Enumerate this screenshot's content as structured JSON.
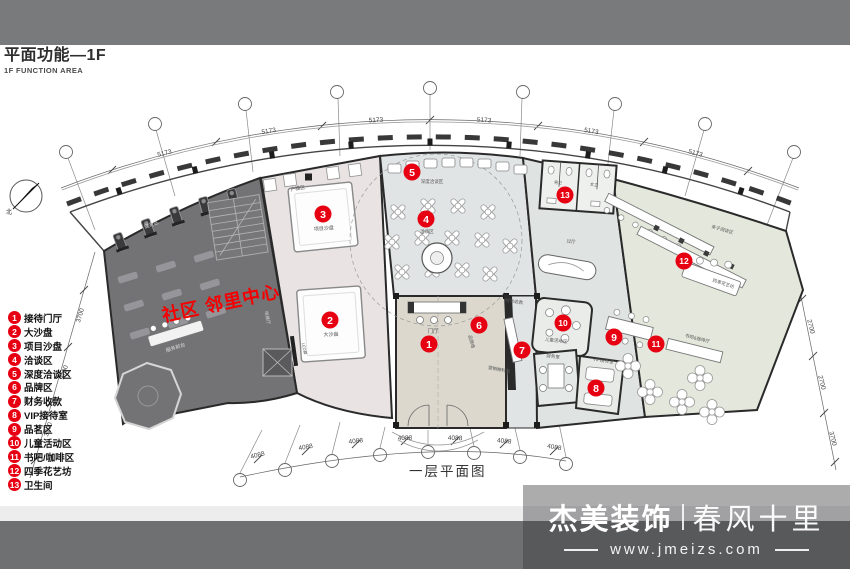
{
  "header": {
    "title": "平面功能—1F",
    "subtitle": "1F FUNCTION AREA"
  },
  "compass": {
    "label": "北"
  },
  "plan": {
    "title": "一层平面图",
    "overlay_text": "社区 邻里中心",
    "accent_red": "#e60012",
    "markers": [
      {
        "n": "1",
        "x": 429,
        "y": 344
      },
      {
        "n": "2",
        "x": 330,
        "y": 320
      },
      {
        "n": "3",
        "x": 323,
        "y": 214
      },
      {
        "n": "4",
        "x": 426,
        "y": 219
      },
      {
        "n": "5",
        "x": 412,
        "y": 172
      },
      {
        "n": "6",
        "x": 479,
        "y": 325
      },
      {
        "n": "7",
        "x": 522,
        "y": 350
      },
      {
        "n": "8",
        "x": 596,
        "y": 388
      },
      {
        "n": "9",
        "x": 614,
        "y": 337
      },
      {
        "n": "10",
        "x": 563,
        "y": 323
      },
      {
        "n": "11",
        "x": 656,
        "y": 344
      },
      {
        "n": "12",
        "x": 684,
        "y": 261
      },
      {
        "n": "13",
        "x": 565,
        "y": 195
      }
    ],
    "room_labels": [
      {
        "text": "健身区",
        "x": 152,
        "y": 226,
        "rot": -20,
        "size": 5,
        "color": "#dedede"
      },
      {
        "text": "服务前台",
        "x": 176,
        "y": 349,
        "rot": -18,
        "size": 5,
        "color": "#dedede"
      },
      {
        "text": "电梯厅",
        "x": 266,
        "y": 318,
        "rot": 78,
        "size": 4.5,
        "color": "#cfcfcf"
      },
      {
        "text": "户模区",
        "x": 298,
        "y": 190,
        "rot": -10,
        "size": 5,
        "color": "#555"
      },
      {
        "text": "项目沙盘",
        "x": 324,
        "y": 230,
        "rot": -4,
        "size": 5,
        "color": "#555"
      },
      {
        "text": "大沙盘",
        "x": 331,
        "y": 336,
        "rot": -2,
        "size": 5,
        "color": "#555"
      },
      {
        "text": "LED屏",
        "x": 303,
        "y": 349,
        "rot": 78,
        "size": 4,
        "color": "#555"
      },
      {
        "text": "深度洽谈区",
        "x": 432,
        "y": 183,
        "rot": 0,
        "size": 4.5,
        "color": "#555"
      },
      {
        "text": "洽谈区",
        "x": 427,
        "y": 233,
        "rot": 0,
        "size": 4.5,
        "color": "#555"
      },
      {
        "text": "门厅",
        "x": 433,
        "y": 333,
        "rot": 0,
        "size": 5.5,
        "color": "#555"
      },
      {
        "text": "品牌墙",
        "x": 470,
        "y": 342,
        "rot": 75,
        "size": 4.5,
        "color": "#555"
      },
      {
        "text": "营销物料间",
        "x": 499,
        "y": 371,
        "rot": 10,
        "size": 4.5,
        "color": "#555"
      },
      {
        "text": "财务收款",
        "x": 514,
        "y": 303,
        "rot": 8,
        "size": 4.5,
        "color": "#555"
      },
      {
        "text": "财务室",
        "x": 553,
        "y": 358,
        "rot": 6,
        "size": 4.5,
        "color": "#555"
      },
      {
        "text": "儿童活动区",
        "x": 556,
        "y": 342,
        "rot": 6,
        "size": 4.5,
        "color": "#555"
      },
      {
        "text": "VIP接待室",
        "x": 603,
        "y": 362,
        "rot": 8,
        "size": 4.5,
        "color": "#555"
      },
      {
        "text": "男卫",
        "x": 558,
        "y": 184,
        "rot": 4,
        "size": 4,
        "color": "#555"
      },
      {
        "text": "女卫",
        "x": 594,
        "y": 186,
        "rot": 6,
        "size": 4,
        "color": "#555"
      },
      {
        "text": "过厅",
        "x": 571,
        "y": 243,
        "rot": 6,
        "size": 4.5,
        "color": "#555"
      },
      {
        "text": "亲子阅读区",
        "x": 722,
        "y": 231,
        "rot": 16,
        "size": 4.5,
        "color": "#555"
      },
      {
        "text": "四季花艺坊",
        "x": 723,
        "y": 285,
        "rot": 18,
        "size": 4.5,
        "color": "#555"
      },
      {
        "text": "书吧&咖啡厅",
        "x": 697,
        "y": 340,
        "rot": 14,
        "size": 4.5,
        "color": "#555"
      }
    ],
    "dim_labels": [
      {
        "text": "5173",
        "x": 165,
        "y": 155,
        "rot": -15
      },
      {
        "text": "5173",
        "x": 269,
        "y": 133,
        "rot": -9
      },
      {
        "text": "5173",
        "x": 376,
        "y": 122,
        "rot": -3
      },
      {
        "text": "5173",
        "x": 484,
        "y": 122,
        "rot": 3
      },
      {
        "text": "5173",
        "x": 591,
        "y": 133,
        "rot": 9
      },
      {
        "text": "5173",
        "x": 695,
        "y": 155,
        "rot": 15
      },
      {
        "text": "4088",
        "x": 258,
        "y": 457,
        "rot": -14
      },
      {
        "text": "4088",
        "x": 306,
        "y": 449,
        "rot": -10
      },
      {
        "text": "4088",
        "x": 356,
        "y": 443,
        "rot": -6
      },
      {
        "text": "4088",
        "x": 405,
        "y": 440,
        "rot": -2
      },
      {
        "text": "4088",
        "x": 455,
        "y": 440,
        "rot": 2
      },
      {
        "text": "4088",
        "x": 504,
        "y": 443,
        "rot": 6
      },
      {
        "text": "4088",
        "x": 554,
        "y": 449,
        "rot": 10
      },
      {
        "text": "3700",
        "x": 82,
        "y": 316,
        "rot": -73
      },
      {
        "text": "3700",
        "x": 66,
        "y": 373,
        "rot": -73
      },
      {
        "text": "3700",
        "x": 50,
        "y": 430,
        "rot": -73
      },
      {
        "text": "2700",
        "x": 809,
        "y": 327,
        "rot": 76
      },
      {
        "text": "2700",
        "x": 820,
        "y": 383,
        "rot": 76
      },
      {
        "text": "3700",
        "x": 831,
        "y": 439,
        "rot": 76
      }
    ]
  },
  "legend": {
    "items": [
      {
        "num": "1",
        "label": "接待门厅"
      },
      {
        "num": "2",
        "label": "大沙盘"
      },
      {
        "num": "3",
        "label": "项目沙盘"
      },
      {
        "num": "4",
        "label": "洽谈区"
      },
      {
        "num": "5",
        "label": "深度洽谈区"
      },
      {
        "num": "6",
        "label": "品牌区"
      },
      {
        "num": "7",
        "label": "财务收款"
      },
      {
        "num": "8",
        "label": "VIP接待室"
      },
      {
        "num": "9",
        "label": "品茗区"
      },
      {
        "num": "10",
        "label": "儿童活动区"
      },
      {
        "num": "11",
        "label": "书吧/咖啡区"
      },
      {
        "num": "12",
        "label": "四季花艺坊"
      },
      {
        "num": "13",
        "label": "卫生间"
      }
    ]
  },
  "footer": {
    "brand": "杰美装饰",
    "slogan": "春风十里",
    "website": "www.jmeizs.com"
  }
}
